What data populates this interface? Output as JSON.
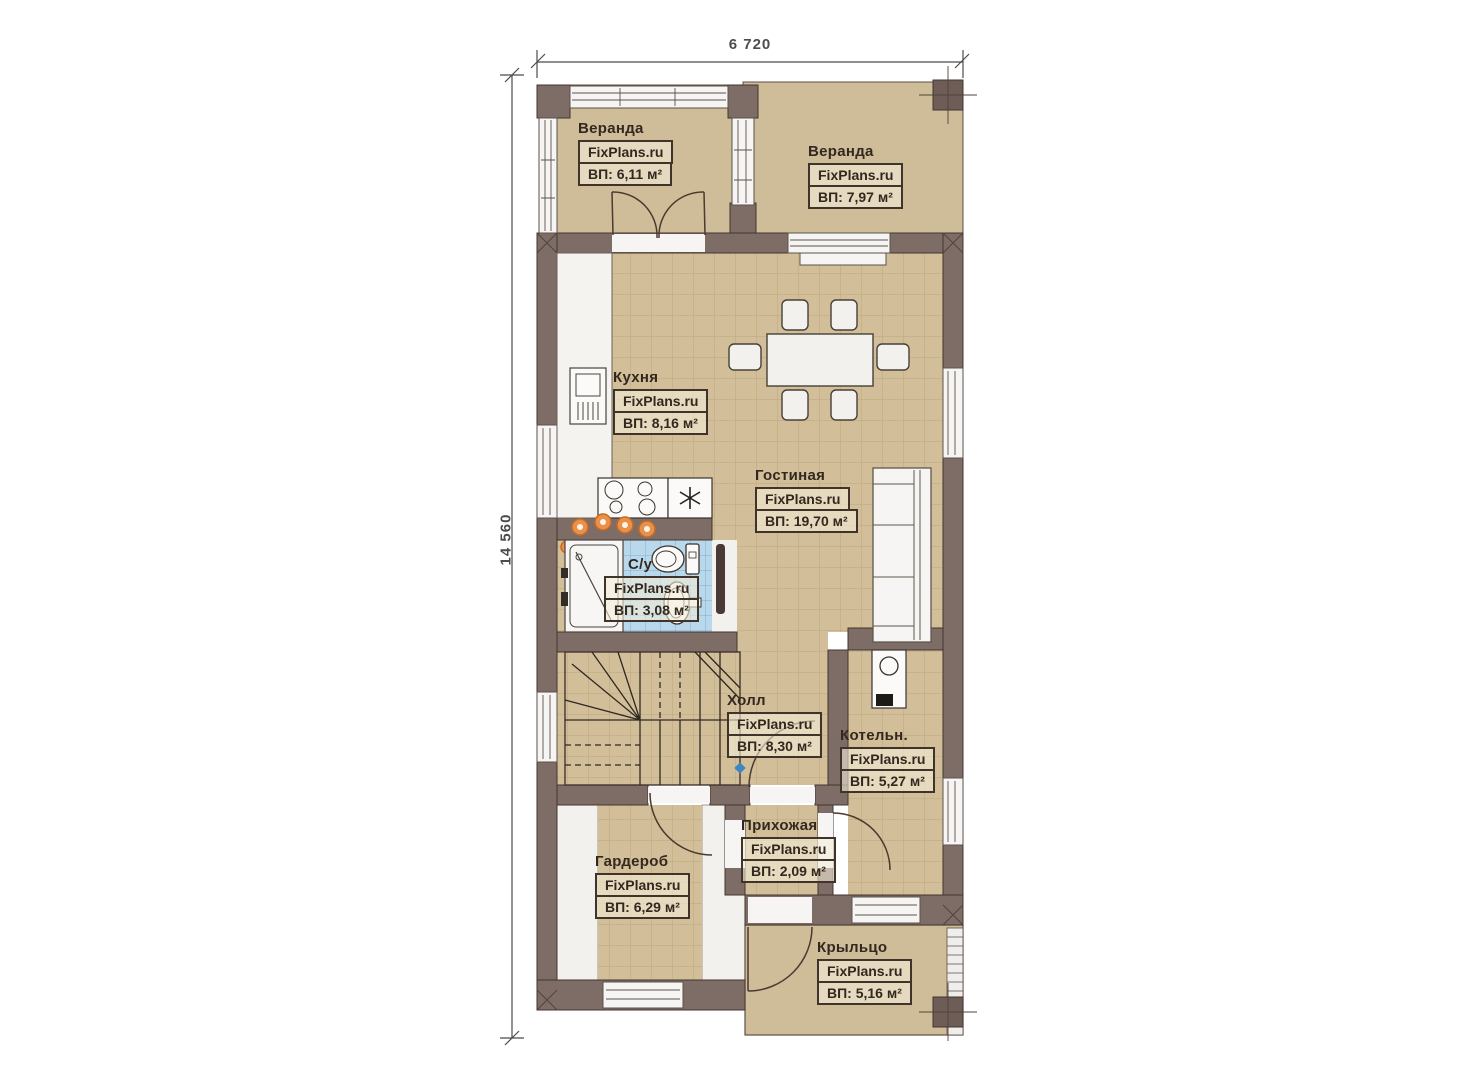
{
  "dimensions": {
    "width_label": "6 720",
    "height_label": "14 560"
  },
  "watermark": "FixPlans.ru",
  "rooms": [
    {
      "id": "veranda-left",
      "name": "Веранда",
      "brand": "FixPlans.ru",
      "area": "ВП: 6,11 м²"
    },
    {
      "id": "veranda-right",
      "name": "Веранда",
      "brand": "FixPlans.ru",
      "area": "ВП: 7,97 м²"
    },
    {
      "id": "kitchen",
      "name": "Кухня",
      "brand": "FixPlans.ru",
      "area": "ВП: 8,16 м²"
    },
    {
      "id": "living-room",
      "name": "Гостиная",
      "brand": "FixPlans.ru",
      "area": "ВП: 19,70 м²"
    },
    {
      "id": "bathroom",
      "name": "С/у",
      "brand": "FixPlans.ru",
      "area": "ВП: 3,08 м²"
    },
    {
      "id": "hall",
      "name": "Холл",
      "brand": "FixPlans.ru",
      "area": "ВП: 8,30 м²"
    },
    {
      "id": "boiler-room",
      "name": "Котельн.",
      "brand": "FixPlans.ru",
      "area": "ВП: 5,27 м²"
    },
    {
      "id": "entry",
      "name": "Прихожая",
      "brand": "FixPlans.ru",
      "area": "ВП: 2,09 м²"
    },
    {
      "id": "wardrobe",
      "name": "Гардероб",
      "brand": "FixPlans.ru",
      "area": "ВП: 6,29 м²"
    },
    {
      "id": "porch",
      "name": "Крыльцо",
      "brand": "FixPlans.ru",
      "area": "ВП: 5,16 м²"
    }
  ],
  "colors": {
    "wall": "#7e6d67",
    "floor_tile": "#d2bf99",
    "tile_line": "#a8946a",
    "veranda_floor": "#cfbc98",
    "bathroom_tile": "#b9d8eb",
    "lamp_accent": "#e8914a",
    "label_text": "#33281f"
  }
}
